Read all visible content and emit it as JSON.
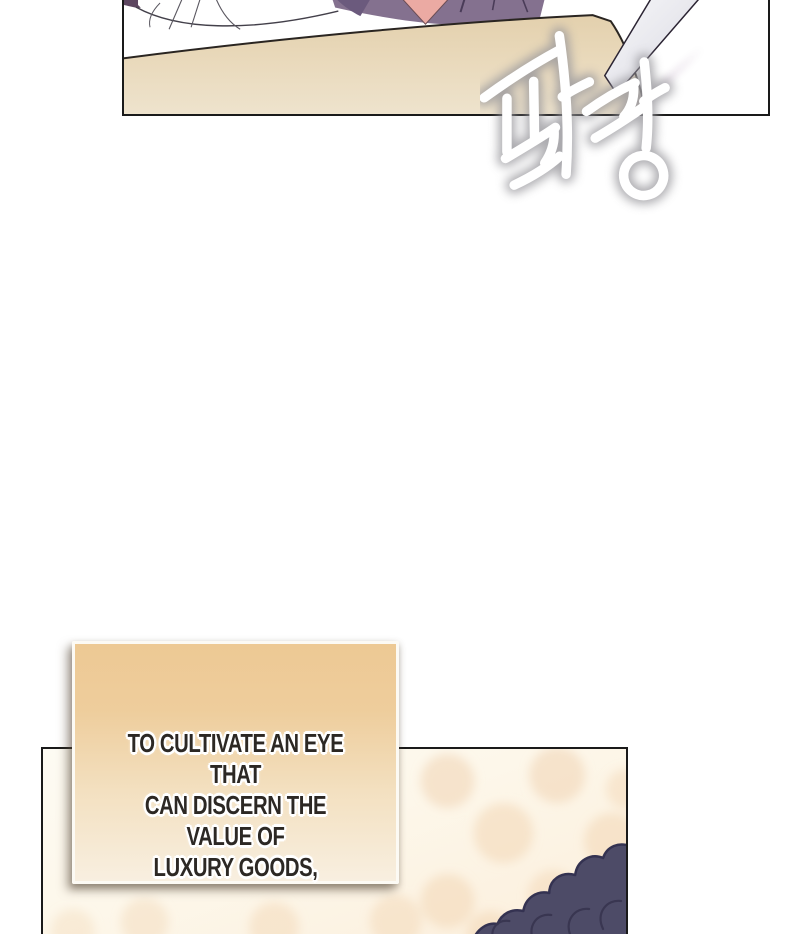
{
  "sfx": {
    "text": "팔랑",
    "color": "#ffffff",
    "glow_color": "#97969b"
  },
  "caption": {
    "lines": [
      "TO CULTIVATE AN EYE THAT",
      "CAN DISCERN THE VALUE OF",
      "LUXURY GOODS,"
    ],
    "text_color": "#2c2824",
    "box_gradient_top": "#edc994",
    "box_gradient_bottom": "#f8efe0",
    "border_color": "#fcfaf4"
  },
  "top_panel": {
    "colors": {
      "border": "#1a1a1a",
      "table_tan": "#e6d3b2",
      "garment_purple": "#84718f",
      "garment_purple_dark": "#5e4d6b",
      "skin_pink": "#ebaaa3",
      "paper_white": "#ffffff",
      "paper_blade_gray": "#e9e9ef",
      "cone_purple": "#9b7ba1",
      "corner_maroon": "#5d4660"
    }
  },
  "bottom_panel": {
    "colors": {
      "border": "#1a1a1a",
      "background_top": "#fdfbf3",
      "background_bottom": "#fbeedb",
      "dot_peach": "#f1d4b2",
      "hair_navy": "#4d4b67",
      "hair_outline": "#343251"
    }
  }
}
